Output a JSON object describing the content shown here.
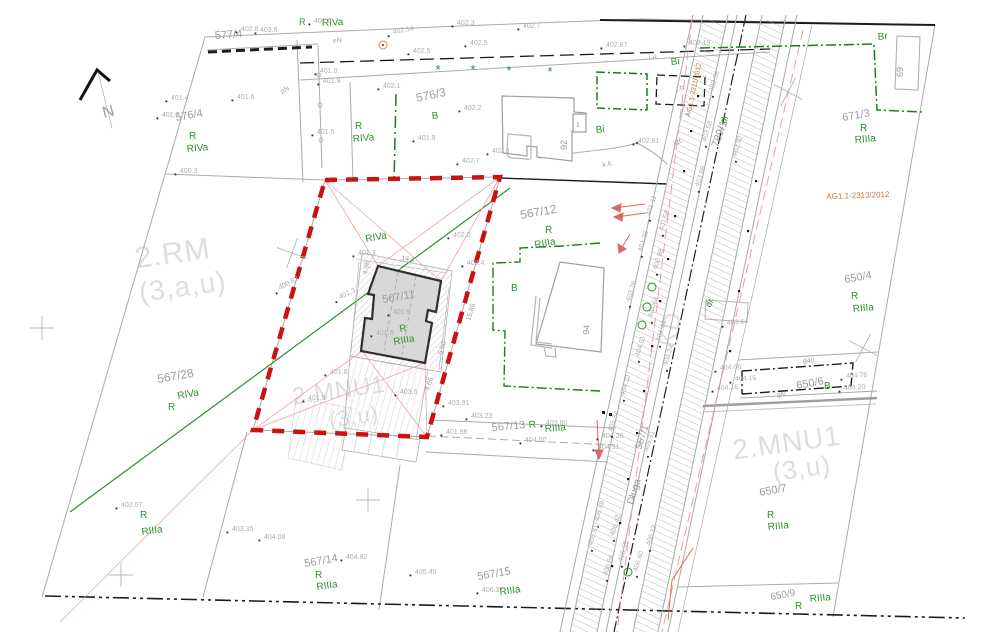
{
  "colors": {
    "background": "#ffffff",
    "parcel_line": "#ababab",
    "parcel_text": "#9b9b9b",
    "zone_text": "#dedede",
    "landuse_green": "#2f8f2f",
    "boundary_green": "#1f7a1f",
    "investment_boundary_red": "#cc1111",
    "tie_line_pink": "#eba6a6",
    "arrow_red": "#dd6666",
    "survey_note_orange": "#c8743c",
    "building_fill": "#d8d8d8",
    "building_stroke": "#2f2f2f",
    "black_line": "#1c1c1c"
  },
  "labels": [
    {
      "t": "577/4",
      "x": 215,
      "y": 39,
      "s": 11,
      "c": "parcel",
      "r": -4
    },
    {
      "t": "576/4",
      "x": 176,
      "y": 121,
      "s": 11,
      "c": "parcel",
      "r": -10
    },
    {
      "t": "576/3",
      "x": 417,
      "y": 102,
      "s": 12,
      "c": "parcel",
      "r": -12
    },
    {
      "t": "567/12",
      "x": 521,
      "y": 219,
      "s": 12,
      "c": "parcel",
      "r": -10
    },
    {
      "t": "567/11",
      "x": 383,
      "y": 303,
      "s": 11,
      "c": "parcel",
      "r": -10
    },
    {
      "t": "567/28",
      "x": 158,
      "y": 383,
      "s": 12,
      "c": "parcel",
      "r": -10
    },
    {
      "t": "567/13",
      "x": 492,
      "y": 431,
      "s": 11,
      "c": "parcel",
      "r": -5
    },
    {
      "t": "567/14",
      "x": 305,
      "y": 567,
      "s": 11,
      "c": "parcel",
      "r": -10
    },
    {
      "t": "567/15",
      "x": 478,
      "y": 580,
      "s": 11,
      "c": "parcel",
      "r": -10
    },
    {
      "t": "650/4",
      "x": 845,
      "y": 283,
      "s": 11,
      "c": "parcel",
      "r": -10
    },
    {
      "t": "650/6",
      "x": 797,
      "y": 389,
      "s": 11,
      "c": "parcel",
      "r": -10
    },
    {
      "t": "650/7",
      "x": 760,
      "y": 496,
      "s": 11,
      "c": "parcel",
      "r": -10
    },
    {
      "t": "650/9",
      "x": 771,
      "y": 600,
      "s": 10,
      "c": "parcel",
      "r": -10
    },
    {
      "t": "671/3",
      "x": 843,
      "y": 121,
      "s": 11,
      "c": "parcel",
      "r": -10
    },
    {
      "t": "789/1",
      "x": 718,
      "y": 148,
      "s": 11,
      "c": "parcel",
      "r": -70
    },
    {
      "t": "567/1",
      "x": 641,
      "y": 450,
      "s": 10,
      "c": "parcel",
      "r": -72
    },
    {
      "t": "Długa",
      "x": 633,
      "y": 505,
      "s": 10,
      "c": "parcel",
      "r": -73
    },
    {
      "t": "92",
      "x": 567,
      "y": 150,
      "s": 9,
      "c": "parcel",
      "r": -90
    },
    {
      "t": "94",
      "x": 589,
      "y": 335,
      "s": 9,
      "c": "parcel",
      "r": -85
    },
    {
      "t": "69",
      "x": 903,
      "y": 77,
      "s": 9,
      "c": "parcel",
      "r": -90
    },
    {
      "t": "1",
      "x": 576,
      "y": 127,
      "s": 7,
      "c": "parcel",
      "r": 0
    },
    {
      "t": "N",
      "x": 104,
      "y": 118,
      "s": 16,
      "c": "parcel",
      "r": -15
    },
    {
      "t": "2.RM",
      "x": 174,
      "y": 263,
      "s": 30,
      "c": "zone",
      "r": -8,
      "a": "middle"
    },
    {
      "t": "(3,a,u)",
      "x": 184,
      "y": 296,
      "s": 28,
      "c": "zone",
      "r": -8,
      "a": "middle"
    },
    {
      "t": "2.MNU1",
      "x": 340,
      "y": 398,
      "s": 24,
      "c": "zone",
      "r": -8,
      "a": "middle"
    },
    {
      "t": "(3,u)",
      "x": 355,
      "y": 424,
      "s": 22,
      "c": "zone",
      "r": -8,
      "a": "middle"
    },
    {
      "t": "2.MNU1",
      "x": 788,
      "y": 452,
      "s": 28,
      "c": "zone",
      "r": -8,
      "a": "middle"
    },
    {
      "t": "(3,u)",
      "x": 803,
      "y": 477,
      "s": 26,
      "c": "zone",
      "r": -8,
      "a": "middle"
    },
    {
      "t": "KD",
      "x": 678,
      "y": 331,
      "s": 24,
      "c": "zone",
      "r": -78,
      "a": "middle"
    },
    {
      "t": "R",
      "x": 299,
      "y": 25,
      "s": 9,
      "c": "green"
    },
    {
      "t": "RIVa",
      "x": 322,
      "y": 26,
      "s": 10,
      "c": "green",
      "r": -3
    },
    {
      "t": "R",
      "x": 189,
      "y": 139,
      "s": 10,
      "c": "green"
    },
    {
      "t": "RIVa",
      "x": 187,
      "y": 152,
      "s": 10,
      "c": "green",
      "r": -5
    },
    {
      "t": "R",
      "x": 355,
      "y": 129,
      "s": 10,
      "c": "green"
    },
    {
      "t": "RIVa",
      "x": 353,
      "y": 142,
      "s": 10,
      "c": "green",
      "r": -5
    },
    {
      "t": "B",
      "x": 432,
      "y": 119,
      "s": 10,
      "c": "green",
      "r": -5
    },
    {
      "t": "Bi",
      "x": 596,
      "y": 133,
      "s": 10,
      "c": "green",
      "r": -5
    },
    {
      "t": "Bi",
      "x": 671,
      "y": 65,
      "s": 10,
      "c": "green",
      "r": -5
    },
    {
      "t": "Br",
      "x": 878,
      "y": 40,
      "s": 10,
      "c": "green",
      "r": -5
    },
    {
      "t": "R",
      "x": 860,
      "y": 131,
      "s": 10,
      "c": "green"
    },
    {
      "t": "RIIIa",
      "x": 855,
      "y": 143,
      "s": 10,
      "c": "green",
      "r": -5
    },
    {
      "t": "dr",
      "x": 725,
      "y": 124,
      "s": 9,
      "c": "green",
      "r": -60
    },
    {
      "t": "dr",
      "x": 710,
      "y": 308,
      "s": 9,
      "c": "green",
      "r": -60
    },
    {
      "t": "RIVa",
      "x": 366,
      "y": 242,
      "s": 10,
      "c": "green",
      "r": -10
    },
    {
      "t": "R",
      "x": 400,
      "y": 332,
      "s": 10,
      "c": "green",
      "r": -10
    },
    {
      "t": "RIIIa",
      "x": 394,
      "y": 345,
      "s": 10,
      "c": "green",
      "r": -10
    },
    {
      "t": "R",
      "x": 545,
      "y": 233,
      "s": 10,
      "c": "green"
    },
    {
      "t": "RIIIa",
      "x": 535,
      "y": 248,
      "s": 10,
      "c": "green",
      "r": -10
    },
    {
      "t": "B",
      "x": 511,
      "y": 291,
      "s": 10,
      "c": "green"
    },
    {
      "t": "R",
      "x": 529,
      "y": 428,
      "s": 10,
      "c": "green",
      "r": -5
    },
    {
      "t": "RIIIa",
      "x": 545,
      "y": 432,
      "s": 10,
      "c": "green",
      "r": -5
    },
    {
      "t": "RIVa",
      "x": 178,
      "y": 399,
      "s": 10,
      "c": "green",
      "r": -10
    },
    {
      "t": "R",
      "x": 168,
      "y": 410,
      "s": 10,
      "c": "green"
    },
    {
      "t": "R",
      "x": 140,
      "y": 518,
      "s": 10,
      "c": "green"
    },
    {
      "t": "RIIIa",
      "x": 142,
      "y": 535,
      "s": 10,
      "c": "green",
      "r": -8
    },
    {
      "t": "R",
      "x": 315,
      "y": 578,
      "s": 10,
      "c": "green"
    },
    {
      "t": "RIIIa",
      "x": 317,
      "y": 590,
      "s": 10,
      "c": "green",
      "r": -8
    },
    {
      "t": "RIIIa",
      "x": 500,
      "y": 595,
      "s": 10,
      "c": "green",
      "r": -8
    },
    {
      "t": "B",
      "x": 824,
      "y": 389,
      "s": 10,
      "c": "green"
    },
    {
      "t": "R",
      "x": 851,
      "y": 299,
      "s": 10,
      "c": "green"
    },
    {
      "t": "RIIIa",
      "x": 853,
      "y": 312,
      "s": 10,
      "c": "green",
      "r": -5
    },
    {
      "t": "R",
      "x": 767,
      "y": 518,
      "s": 10,
      "c": "green"
    },
    {
      "t": "RIIIa",
      "x": 768,
      "y": 530,
      "s": 10,
      "c": "green",
      "r": -5
    },
    {
      "t": "R",
      "x": 795,
      "y": 609,
      "s": 10,
      "c": "green"
    },
    {
      "t": "RIIIa",
      "x": 810,
      "y": 602,
      "s": 10,
      "c": "green",
      "r": -5
    },
    {
      "t": "*",
      "x": 438,
      "y": 74,
      "s": 13,
      "c": "green",
      "a": "middle"
    },
    {
      "t": "*",
      "x": 473,
      "y": 74,
      "s": 13,
      "c": "green",
      "a": "middle"
    },
    {
      "t": "*",
      "x": 509,
      "y": 75,
      "s": 13,
      "c": "green",
      "a": "middle"
    },
    {
      "t": "*",
      "x": 550,
      "y": 76,
      "s": 13,
      "c": "green",
      "a": "middle"
    },
    {
      "t": "AG1.1-2313/2012",
      "x": 858,
      "y": 198,
      "s": 8,
      "c": "redtext",
      "r": -2,
      "a": "middle"
    },
    {
      "t": "AG1.1-2311/2012",
      "x": 690,
      "y": 117,
      "s": 7,
      "c": "redtext",
      "r": -78
    },
    {
      "t": "eN",
      "x": 333,
      "y": 43,
      "s": 7,
      "c": "tiny",
      "r": -5
    },
    {
      "t": "pN",
      "x": 282,
      "y": 94,
      "s": 7,
      "c": "tiny",
      "r": -30
    },
    {
      "t": "k.k.",
      "x": 603,
      "y": 167,
      "s": 7,
      "c": "tiny",
      "r": -10
    },
    {
      "t": "g40",
      "x": 803,
      "y": 363,
      "s": 7,
      "c": "tiny",
      "r": -3
    },
    {
      "t": "gN",
      "x": 777,
      "y": 397,
      "s": 7,
      "c": "tiny",
      "r": -3
    },
    {
      "t": "j.b.",
      "x": 677,
      "y": 91,
      "s": 7,
      "c": "tiny",
      "r": -15
    },
    {
      "t": "j.d.",
      "x": 674,
      "y": 145,
      "s": 7,
      "c": "tiny",
      "r": -15
    },
    {
      "t": "j.a.",
      "x": 649,
      "y": 59,
      "s": 7,
      "c": "tiny",
      "r": -10
    },
    {
      "t": "14.1",
      "x": 401,
      "y": 260,
      "s": 7,
      "c": "dim",
      "r": 8
    },
    {
      "t": "4.98",
      "x": 367,
      "y": 275,
      "s": 7,
      "c": "dim",
      "r": -78
    },
    {
      "t": "15.86",
      "x": 470,
      "y": 321,
      "s": 7,
      "c": "dim",
      "r": -72
    },
    {
      "t": "5.50",
      "x": 442,
      "y": 355,
      "s": 7,
      "c": "dim",
      "r": -72
    },
    {
      "t": "4.66",
      "x": 429,
      "y": 391,
      "s": 7,
      "c": "dim",
      "r": -72
    },
    {
      "t": "401.8",
      "x": 314,
      "y": 23
    },
    {
      "t": "402.3",
      "x": 457,
      "y": 25
    },
    {
      "t": "402.7",
      "x": 523,
      "y": 28
    },
    {
      "t": "403.6",
      "x": 260,
      "y": 32
    },
    {
      "t": "402.8",
      "x": 241,
      "y": 31
    },
    {
      "t": "402.14",
      "x": 393,
      "y": 34,
      "r": -10
    },
    {
      "t": "402.5",
      "x": 413,
      "y": 53
    },
    {
      "t": "402.5",
      "x": 470,
      "y": 45
    },
    {
      "t": "401.9",
      "x": 320,
      "y": 73
    },
    {
      "t": "401.8",
      "x": 323,
      "y": 83
    },
    {
      "t": "402.1",
      "x": 383,
      "y": 88
    },
    {
      "t": "402.2",
      "x": 464,
      "y": 110
    },
    {
      "t": "401.9",
      "x": 418,
      "y": 140
    },
    {
      "t": "402.3",
      "x": 492,
      "y": 153
    },
    {
      "t": "402.7",
      "x": 462,
      "y": 163
    },
    {
      "t": "401.4",
      "x": 171,
      "y": 100
    },
    {
      "t": "401.3",
      "x": 162,
      "y": 117
    },
    {
      "t": "401.6",
      "x": 237,
      "y": 99
    },
    {
      "t": "401.5",
      "x": 317,
      "y": 134
    },
    {
      "t": "400.3",
      "x": 180,
      "y": 173
    },
    {
      "t": "402.87",
      "x": 606,
      "y": 47
    },
    {
      "t": "402.19",
      "x": 689,
      "y": 45
    },
    {
      "t": "402.81",
      "x": 638,
      "y": 143
    },
    {
      "t": "400.87",
      "x": 280,
      "y": 290,
      "r": -28
    },
    {
      "t": "401.8",
      "x": 330,
      "y": 374
    },
    {
      "t": "401.9",
      "x": 308,
      "y": 400
    },
    {
      "t": "401.3",
      "x": 340,
      "y": 299,
      "r": -25
    },
    {
      "t": "401.6",
      "x": 376,
      "y": 335
    },
    {
      "t": "402.0",
      "x": 453,
      "y": 237
    },
    {
      "t": "402.4",
      "x": 467,
      "y": 265
    },
    {
      "t": "401.9",
      "x": 393,
      "y": 314
    },
    {
      "t": "401.3",
      "x": 358,
      "y": 255
    },
    {
      "t": "403.5",
      "x": 400,
      "y": 394
    },
    {
      "t": "403.91",
      "x": 448,
      "y": 405
    },
    {
      "t": "403.23",
      "x": 471,
      "y": 418
    },
    {
      "t": "401.98",
      "x": 446,
      "y": 434
    },
    {
      "t": "403.80",
      "x": 546,
      "y": 425
    },
    {
      "t": "404.00",
      "x": 525,
      "y": 442
    },
    {
      "t": "404.26",
      "x": 602,
      "y": 438
    },
    {
      "t": "404.31",
      "x": 598,
      "y": 449
    },
    {
      "t": "402.07",
      "x": 121,
      "y": 507
    },
    {
      "t": "403.35",
      "x": 232,
      "y": 531
    },
    {
      "t": "404.08",
      "x": 264,
      "y": 539
    },
    {
      "t": "404.82",
      "x": 346,
      "y": 559
    },
    {
      "t": "405.49",
      "x": 415,
      "y": 574
    },
    {
      "t": "406.37",
      "x": 482,
      "y": 592
    },
    {
      "t": "403.64",
      "x": 727,
      "y": 325,
      "r": -5
    },
    {
      "t": "404.06",
      "x": 720,
      "y": 370,
      "r": -3
    },
    {
      "t": "404.15",
      "x": 735,
      "y": 381,
      "r": -3
    },
    {
      "t": "404.16",
      "x": 717,
      "y": 390,
      "r": -3
    },
    {
      "t": "404.76",
      "x": 846,
      "y": 378,
      "r": -3
    },
    {
      "t": "404.20",
      "x": 844,
      "y": 390,
      "r": -3
    },
    {
      "t": "401.11",
      "x": 650,
      "y": 216,
      "r": -72
    },
    {
      "t": "401.58",
      "x": 663,
      "y": 231,
      "r": -72
    },
    {
      "t": "401.36",
      "x": 642,
      "y": 252,
      "r": -72
    },
    {
      "t": "400.98",
      "x": 657,
      "y": 270,
      "r": -72
    },
    {
      "t": "403.76",
      "x": 630,
      "y": 302,
      "r": -72
    },
    {
      "t": "404.64",
      "x": 652,
      "y": 318,
      "r": -72
    },
    {
      "t": "404.44",
      "x": 660,
      "y": 342,
      "r": -72
    },
    {
      "t": "404.51",
      "x": 639,
      "y": 357,
      "r": -72
    },
    {
      "t": "404.24",
      "x": 667,
      "y": 366,
      "r": -72
    },
    {
      "t": "404.12",
      "x": 624,
      "y": 396,
      "r": -72
    },
    {
      "t": "405.34",
      "x": 612,
      "y": 432,
      "r": -72
    },
    {
      "t": "405.91",
      "x": 648,
      "y": 452,
      "r": -72
    },
    {
      "t": "406.49",
      "x": 598,
      "y": 522,
      "r": -72
    },
    {
      "t": "406.42",
      "x": 614,
      "y": 536,
      "r": -72
    },
    {
      "t": "406.59",
      "x": 622,
      "y": 562,
      "r": -72
    },
    {
      "t": "406.54",
      "x": 607,
      "y": 576,
      "r": -72
    },
    {
      "t": "406.60",
      "x": 637,
      "y": 572,
      "r": -72
    },
    {
      "t": "406.12",
      "x": 650,
      "y": 546,
      "r": -72
    },
    {
      "t": "405.81",
      "x": 592,
      "y": 546,
      "r": -72
    },
    {
      "t": "402.58",
      "x": 713,
      "y": 92,
      "r": -72
    },
    {
      "t": "403.58",
      "x": 706,
      "y": 142,
      "r": -72
    },
    {
      "t": "402.92",
      "x": 736,
      "y": 157,
      "r": -72
    },
    {
      "t": "403.68",
      "x": 699,
      "y": 187,
      "r": -72
    }
  ]
}
